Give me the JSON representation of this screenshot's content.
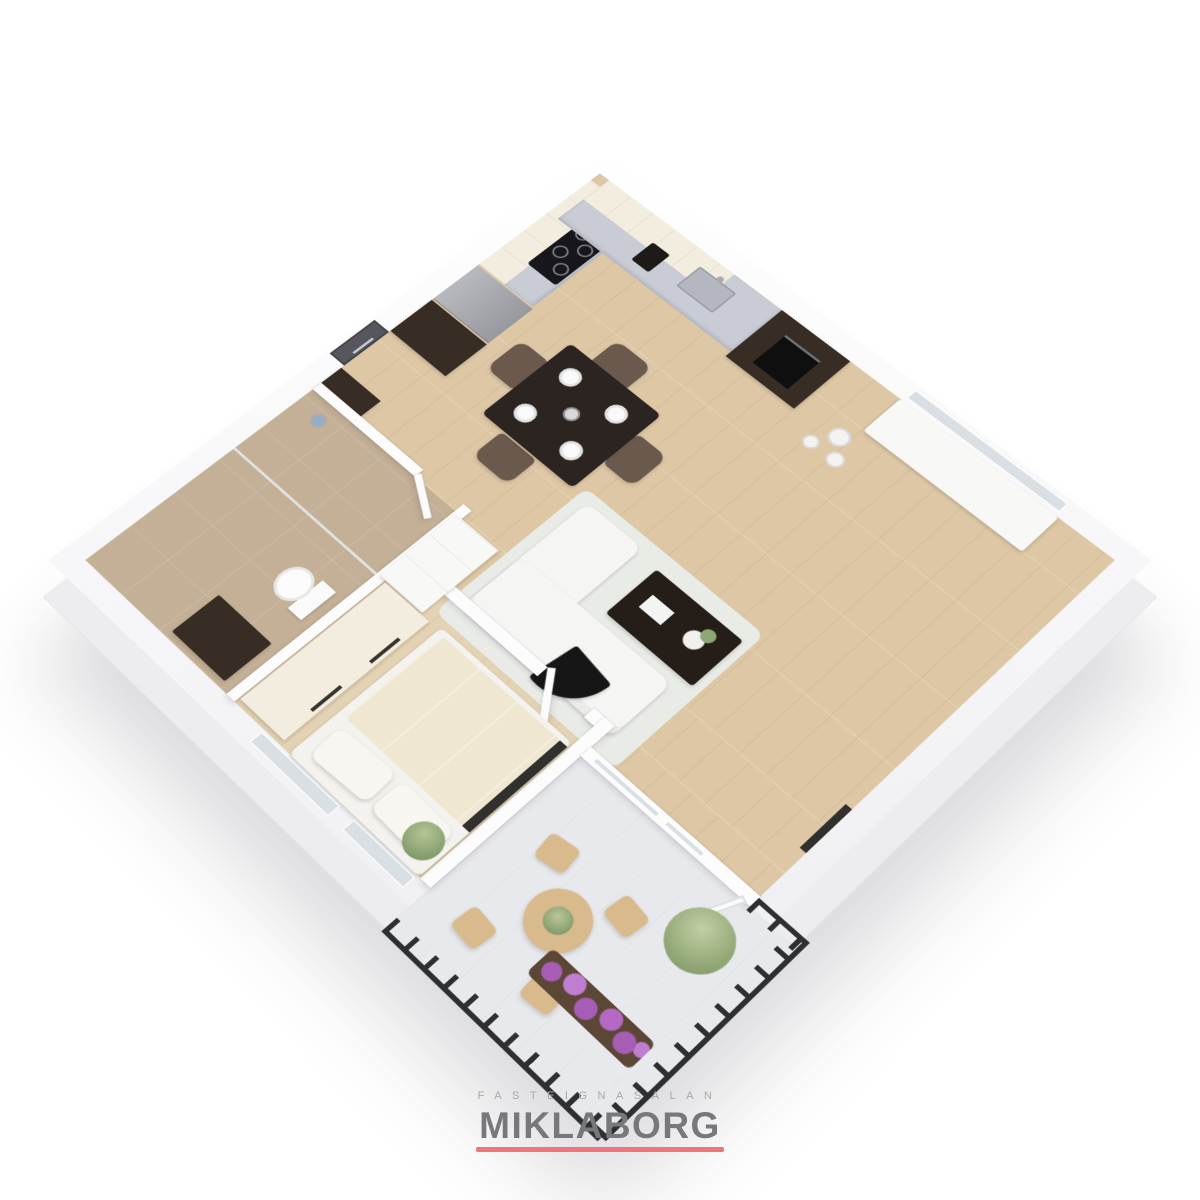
{
  "branding": {
    "tagline": "FASTEIGNASALAN",
    "name": "MIKLABORG"
  },
  "scene": {
    "description": "isometric 3d floor plan rendering of a one-bedroom apartment with kitchen-dining area, living room, bedroom, bathroom, entry hall and corner balcony",
    "rooms": [
      {
        "name": "kitchen-dining"
      },
      {
        "name": "living-room"
      },
      {
        "name": "bedroom"
      },
      {
        "name": "bathroom"
      },
      {
        "name": "entry-hall"
      },
      {
        "name": "balcony"
      }
    ],
    "colors": {
      "wood": "#ddc7a5",
      "wood_bedroom": "#e3d2b4",
      "tile": "#c4b096",
      "facade": "#ededf0",
      "facade_edge": "#e4e4e9",
      "cabinet_dark": "#372d25",
      "cabinet_cream": "#f2edde",
      "counter": "#c9ccd5",
      "steel": "#a9abb1",
      "dining_table": "#2b2420",
      "chair_brown": "#6b594d",
      "sofa": "#f5f5f3",
      "rug": "#e9ebe7",
      "coffee_table": "#241d18",
      "accent_chair": "#161616",
      "bed_duvet": "#efe7d0",
      "pillow": "#f8f6f0",
      "tv": "#31302e",
      "balcony_floor": "#e8e9ec",
      "railing": "#2d2f31",
      "bistro": "#d8ba8d",
      "plant": "#8fa774",
      "plant_dark": "#6f8a58",
      "flowers": "#a75db5",
      "glass": "#d9dfe3",
      "door": "#55575c",
      "brand_text": "#77787c",
      "tagline_color": "#a8a8ac",
      "brand_underline": "#ed767d"
    }
  }
}
